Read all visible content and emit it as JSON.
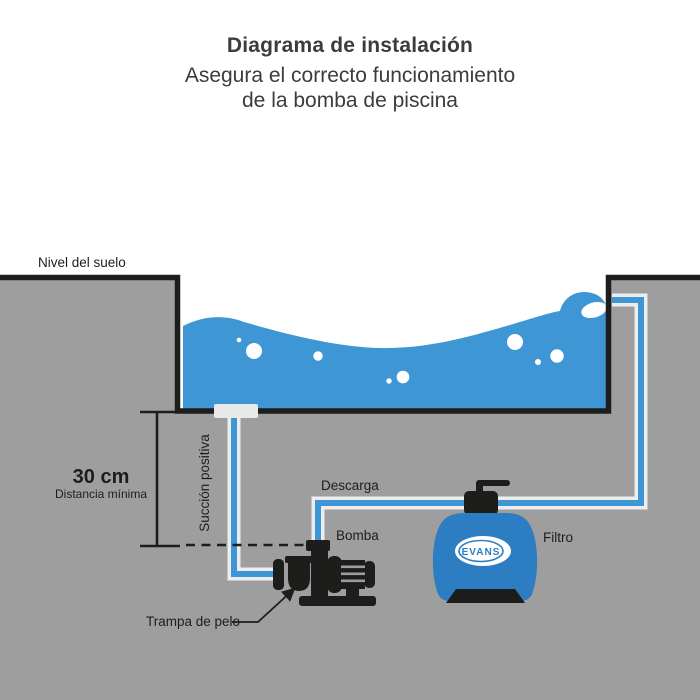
{
  "header": {
    "title": "Diagrama de instalación",
    "subtitle_line1": "Asegura el correcto funcionamiento",
    "subtitle_line2": "de la bomba de piscina"
  },
  "labels": {
    "ground_level": "Nivel del suelo",
    "distance_value": "30 cm",
    "distance_caption": "Distancia mínima",
    "suction": "Succión positiva",
    "discharge": "Descarga",
    "pump": "Bomba",
    "filter": "Filtro",
    "hair_trap": "Trampa de pelo",
    "filter_brand": "EVANS"
  },
  "colors": {
    "ground": "#9e9e9e",
    "outline": "#1d1d1b",
    "water": "#3e97d4",
    "tank": "#2d7dc2",
    "pipe_casing": "#ededed",
    "pipe_core": "#3e97d4",
    "text": "#3c3c3b"
  }
}
